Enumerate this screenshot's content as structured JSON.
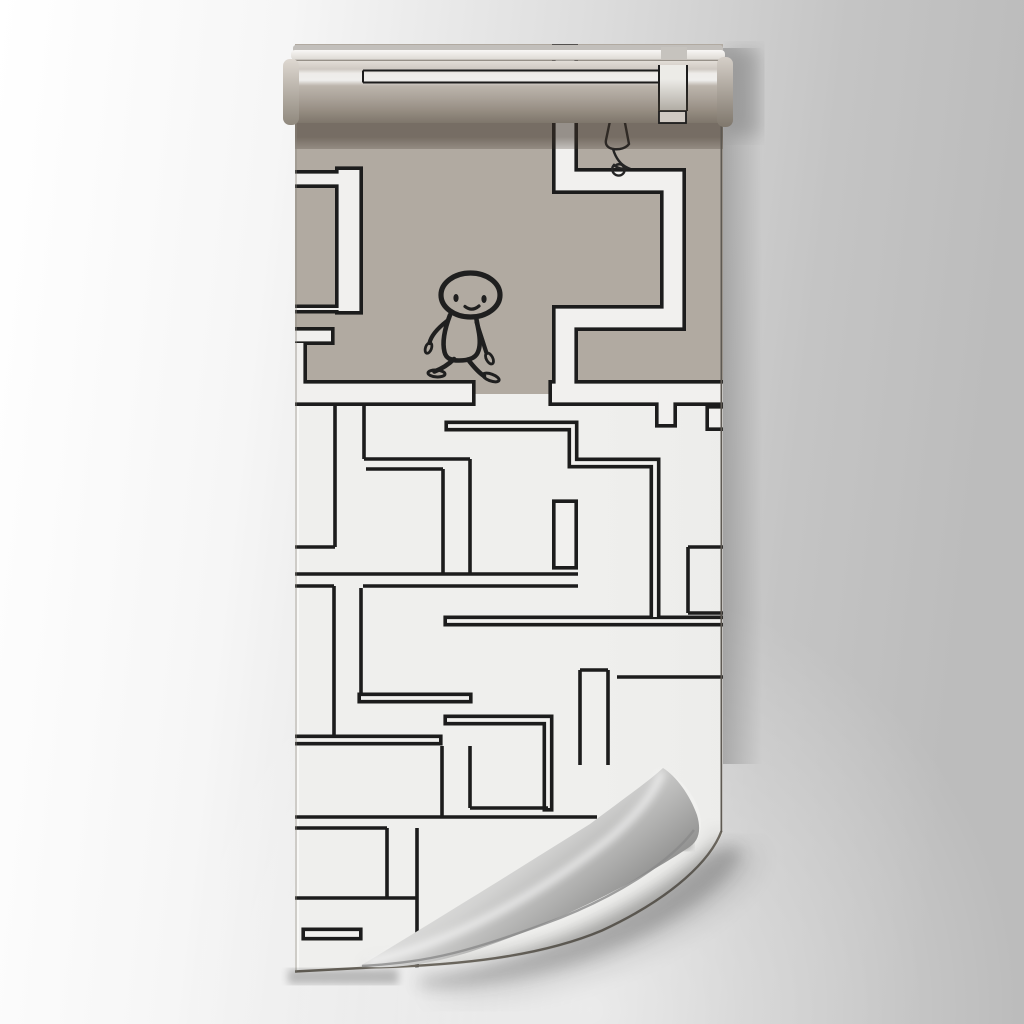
{
  "scene": {
    "kind": "wallpaper-roll-mockup",
    "subject": "maze pattern wallpaper with cartoon walker and scribble figure, curled bottom-right corner"
  },
  "colors": {
    "bgLeft": "#ffffff",
    "bgRight": "#bcbcbc",
    "taupe": "#b1aaa1",
    "sheetWhite": "#eaeae8",
    "bandWhite": "#f1f0ee",
    "ink": "#1c1c1c",
    "rollHighlight": "#f5f4f2",
    "rollTaupe": "#b2aba2",
    "rollDark": "#7e766b",
    "lip": "#f3f2f0",
    "curlLight": "#eeeeee",
    "curlDark": "#9c9c9c",
    "edgeDark": "#6e6960"
  },
  "maze": {
    "outline": 3.6,
    "bands": [
      {
        "name": "ring1-top",
        "w": 18,
        "pts": [
          [
            -6,
            119
          ],
          [
            55,
            119
          ]
        ]
      },
      {
        "name": "ring1-right",
        "w": 28,
        "pts": [
          [
            52,
            110
          ],
          [
            52,
            251
          ]
        ]
      },
      {
        "name": "ring1-bottom",
        "w": 9,
        "pts": [
          [
            -6,
            249
          ],
          [
            58,
            249
          ]
        ]
      },
      {
        "name": "ring2-top",
        "w": 18,
        "pts": [
          [
            -6,
            276
          ],
          [
            34,
            276
          ]
        ]
      },
      {
        "name": "left-edge-strip",
        "w": 16,
        "pts": [
          [
            2,
            283
          ],
          [
            2,
            326
          ]
        ]
      },
      {
        "name": "right-c-structure",
        "w": 26,
        "pts": [
          [
            268,
            -12
          ],
          [
            268,
            121
          ],
          [
            376,
            121
          ],
          [
            376,
            258
          ],
          [
            268,
            258
          ],
          [
            268,
            336
          ]
        ]
      },
      {
        "name": "boundary-left",
        "w": 26,
        "pts": [
          [
            -6,
            333
          ],
          [
            175,
            333
          ]
        ]
      },
      {
        "name": "boundary-right",
        "w": 26,
        "pts": [
          [
            255,
            333
          ],
          [
            442,
            333
          ]
        ]
      },
      {
        "name": "right-stub",
        "w": 22,
        "pts": [
          [
            369,
            326
          ],
          [
            369,
            364
          ]
        ]
      },
      {
        "name": "right-edge-notch",
        "w": 26,
        "pts": [
          [
            412,
            358
          ],
          [
            442,
            358
          ]
        ]
      },
      {
        "name": "snake-corridor",
        "w": 11,
        "pts": [
          [
            151,
            366
          ],
          [
            276,
            366
          ],
          [
            276,
            403
          ],
          [
            358,
            403
          ],
          [
            358,
            557
          ]
        ]
      },
      {
        "name": "u-pocket",
        "w": 26,
        "pts": [
          [
            268,
            443
          ],
          [
            268,
            506
          ]
        ]
      },
      {
        "name": "bar-556",
        "w": 11,
        "pts": [
          [
            150,
            561
          ],
          [
            445,
            561
          ]
        ]
      },
      {
        "name": "bar-637",
        "w": 11,
        "pts": [
          [
            64,
            638
          ],
          [
            172,
            638
          ]
        ]
      },
      {
        "name": "bar-677",
        "w": 11,
        "pts": [
          [
            -6,
            680
          ],
          [
            142,
            680
          ]
        ]
      },
      {
        "name": "bar-655",
        "w": 11,
        "pts": [
          [
            150,
            660
          ],
          [
            251,
            660
          ],
          [
            251,
            748
          ]
        ]
      },
      {
        "name": "bar-874",
        "w": 13,
        "pts": [
          [
            8,
            874
          ],
          [
            62,
            874
          ]
        ]
      }
    ],
    "lines": [
      [
        38,
        346,
        38,
        487
      ],
      [
        -2,
        487,
        38,
        487
      ],
      [
        67,
        346,
        67,
        399
      ],
      [
        67,
        399,
        173,
        399
      ],
      [
        173,
        399,
        173,
        514
      ],
      [
        69,
        409,
        146,
        409
      ],
      [
        146,
        409,
        146,
        514
      ],
      [
        -2,
        514,
        281,
        514
      ],
      [
        -2,
        526,
        37,
        526
      ],
      [
        66,
        526,
        281,
        526
      ],
      [
        37,
        526,
        37,
        675
      ],
      [
        64,
        528,
        64,
        633
      ],
      [
        145,
        686,
        145,
        757
      ],
      [
        173,
        686,
        173,
        748
      ],
      [
        173,
        748,
        251,
        748
      ],
      [
        -2,
        757,
        300,
        757
      ],
      [
        -2,
        768,
        90,
        768
      ],
      [
        90,
        768,
        90,
        838
      ],
      [
        120,
        768,
        120,
        838
      ],
      [
        -2,
        838,
        120,
        838
      ],
      [
        120,
        838,
        120,
        908
      ],
      [
        283,
        610,
        283,
        705
      ],
      [
        311,
        610,
        311,
        705
      ],
      [
        283,
        610,
        311,
        610
      ],
      [
        391,
        487,
        391,
        553
      ],
      [
        391,
        487,
        436,
        487
      ],
      [
        391,
        553,
        436,
        553
      ],
      [
        320,
        617,
        436,
        617
      ]
    ]
  },
  "roll": {
    "printLineY1": 25.5,
    "printLineY2": 37.5,
    "printX1": 76,
    "printX2": 371
  }
}
